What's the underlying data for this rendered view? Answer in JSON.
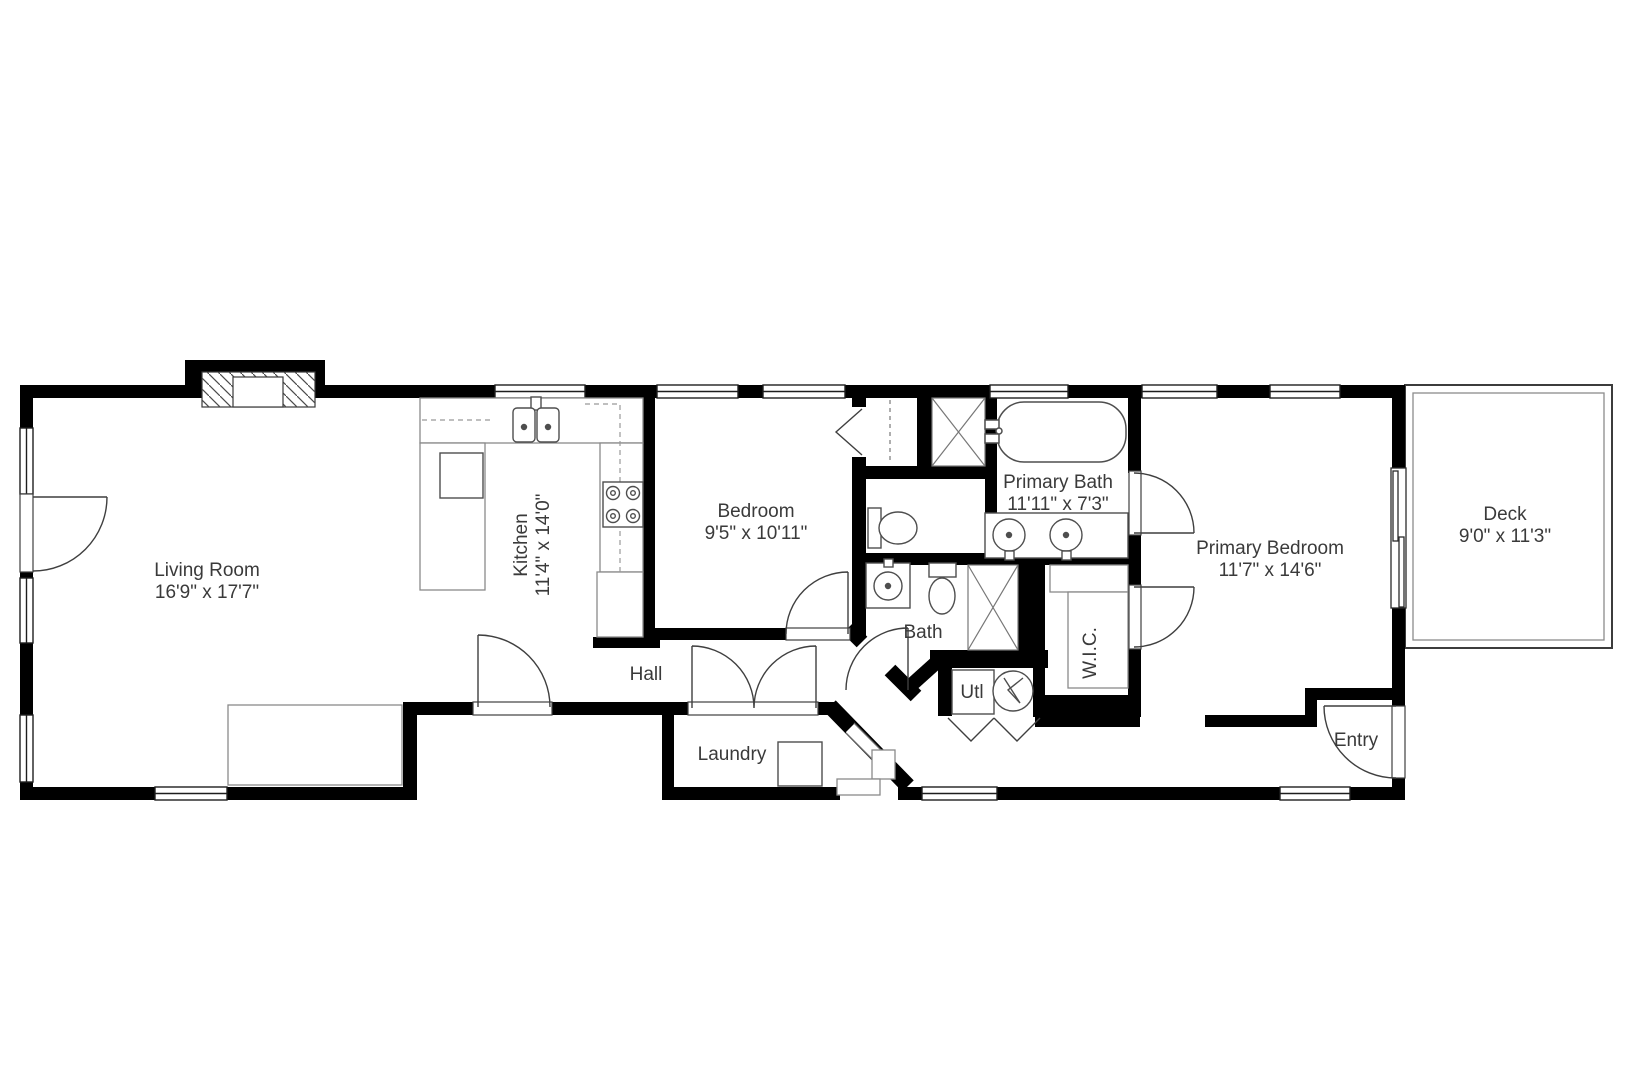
{
  "rooms": {
    "living_room": {
      "name": "Living Room",
      "dims": "16'9\" x 17'7\""
    },
    "kitchen": {
      "name": "Kitchen",
      "dims": "11'4\" x 14'0\""
    },
    "bedroom": {
      "name": "Bedroom",
      "dims": "9'5\" x 10'11\""
    },
    "primary_bath": {
      "name": "Primary Bath",
      "dims": "11'11\" x 7'3\""
    },
    "primary_bedroom": {
      "name": "Primary Bedroom",
      "dims": "11'7\" x 14'6\""
    },
    "deck": {
      "name": "Deck",
      "dims": "9'0\" x 11'3\""
    },
    "bath": {
      "name": "Bath"
    },
    "hall": {
      "name": "Hall"
    },
    "laundry": {
      "name": "Laundry"
    },
    "utility": {
      "name": "Utl"
    },
    "wic": {
      "name": "W.I.C."
    },
    "entry": {
      "name": "Entry"
    }
  },
  "colors": {
    "walls": "#000000",
    "fixture_lines": "#4e4e4e",
    "counter_lines": "#8a8a8a",
    "label_text": "#3a3a3a",
    "background": "#ffffff"
  }
}
